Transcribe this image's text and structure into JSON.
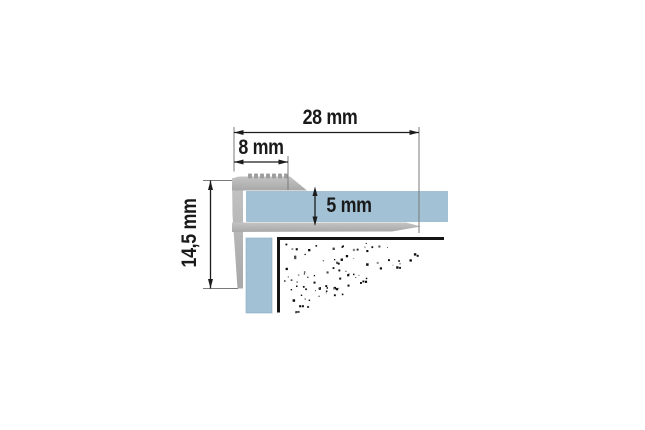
{
  "diagram": {
    "type": "technical-cross-section",
    "labels": {
      "dim_total_width": "28 mm",
      "dim_nose_width": "8 mm",
      "dim_panel_thickness": "5 mm",
      "dim_profile_height": "14,5 mm"
    },
    "colors": {
      "panel_blue": "#a2c1d4",
      "panel_edge": "#7ea6bd",
      "profile_gray_light": "#c4c4c4",
      "profile_gray_dark": "#a8a8a8",
      "serration_gray": "#9e9e9e",
      "substrate_line_black": "#141414",
      "dimension_line": "#1c1c1c",
      "extension_line": "#7a7a7a",
      "background": "#ffffff"
    }
  }
}
